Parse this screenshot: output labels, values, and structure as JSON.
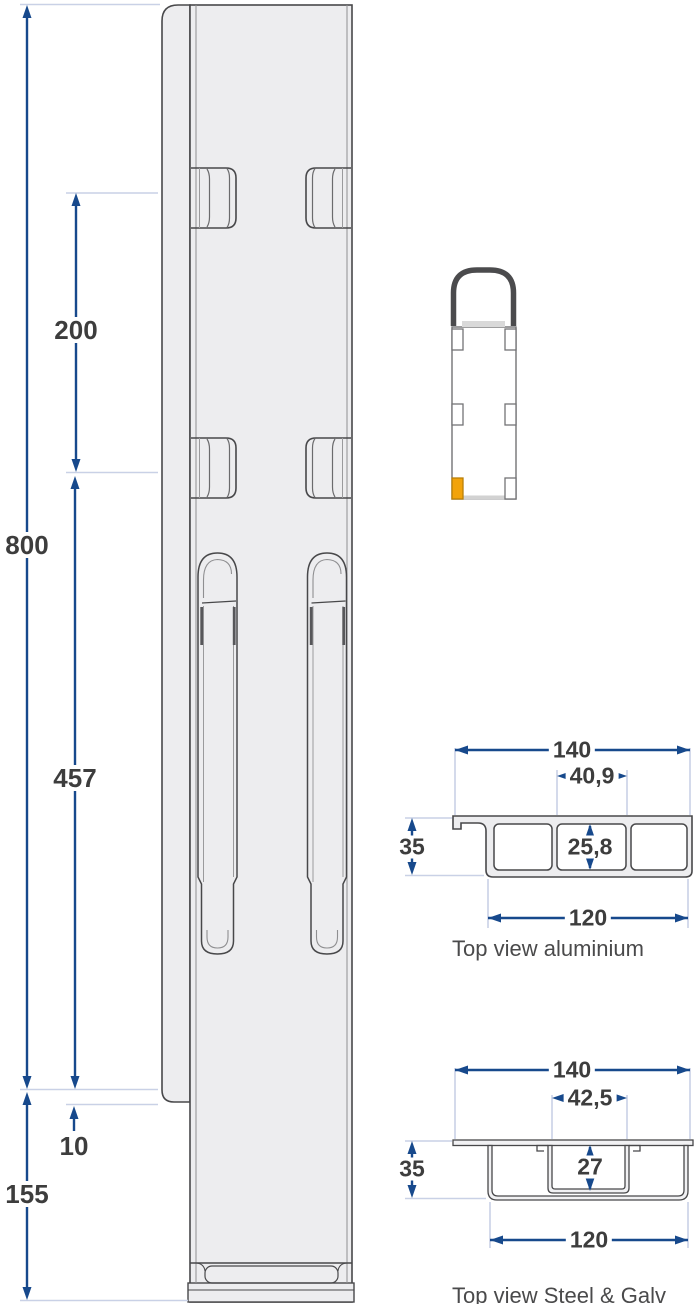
{
  "document": {
    "type": "technical-drawing",
    "subject": "Lashing post side view with truck position inset and two cross-section top views"
  },
  "colors": {
    "dimension_blue": "#17498c",
    "extension_line": "#c9d1e6",
    "outline": "#48484a",
    "profile_fill": "#ededef",
    "highlight_orange": "#f2a30b",
    "label_text": "#3d3d3d"
  },
  "side_view": {
    "dim_800": "800",
    "dim_200": "200",
    "dim_457": "457",
    "dim_10": "10",
    "dim_155": "155"
  },
  "truck_inset": {
    "highlighted_post": "rear-left"
  },
  "aluminium_section": {
    "caption": "Top view aluminium",
    "dim_width_top": "140",
    "dim_pocket_width": "40,9",
    "dim_height": "35",
    "dim_pocket_height": "25,8",
    "dim_width_bottom": "120"
  },
  "steel_section": {
    "caption": "Top view Steel & Galv",
    "dim_width_top": "140",
    "dim_pocket_width": "42,5",
    "dim_height": "35",
    "dim_pocket_height": "27",
    "dim_width_bottom": "120"
  }
}
